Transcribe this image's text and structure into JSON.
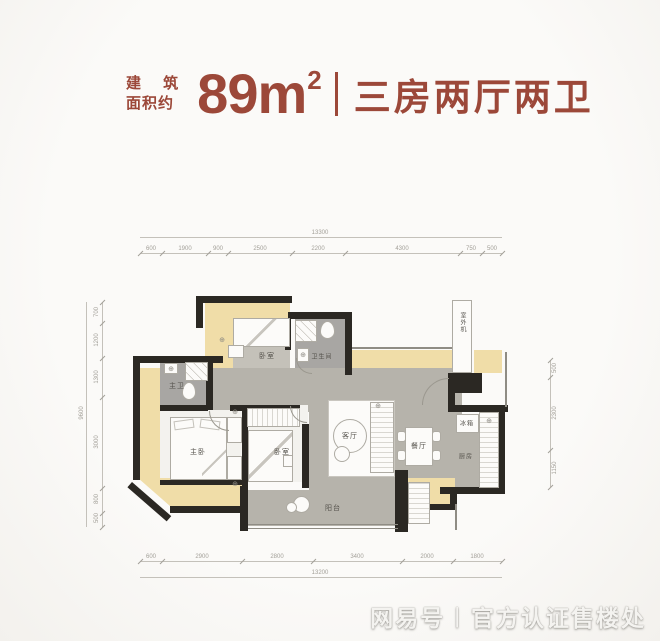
{
  "header": {
    "small_line1": "建 筑",
    "small_line2": "面积约",
    "area_number": "89m",
    "area_exponent": "2",
    "layout_text": "三房两厅两卫",
    "accent_color": "#9c4839"
  },
  "plan": {
    "rooms": {
      "master_bedroom": "主卧",
      "bedroom_top": "卧室",
      "bedroom_mid": "卧室",
      "master_bath": "主卫",
      "bathroom": "卫生间",
      "living": "客厅",
      "dining": "餐厅",
      "kitchen": "厨房",
      "fridge": "冰箱",
      "balcony": "阳台",
      "ac_unit": "室外机"
    },
    "icons": {
      "fixture": "⊕"
    },
    "floor_colors": {
      "bay": "#f0dda8",
      "hall": "#b6b3ab",
      "bath": "#a8a6a3",
      "wall": "#2b2823"
    }
  },
  "dimensions": {
    "top": {
      "total": "13300",
      "segments": [
        "600",
        "1900",
        "900",
        "2500",
        "2200",
        "4300",
        "750",
        "500"
      ]
    },
    "bottom": {
      "total": "13200",
      "segments": [
        "600",
        "2900",
        "2800",
        "3400",
        "2000",
        "1800"
      ]
    },
    "left": {
      "total": "9600",
      "segments": [
        "700",
        "1200",
        "1300",
        "3000",
        "800",
        "500"
      ]
    },
    "right": {
      "segments": [
        "500",
        "2300",
        "1150"
      ]
    }
  },
  "watermark": {
    "brand": "网易号",
    "separator": "|",
    "text": "官方认证售楼处"
  }
}
